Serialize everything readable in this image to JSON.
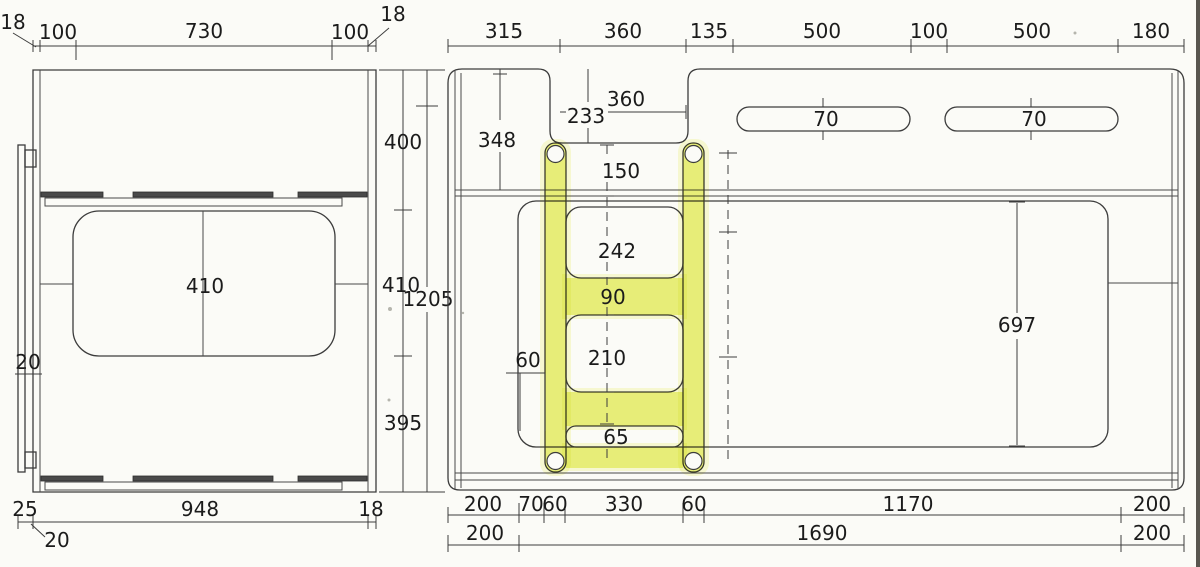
{
  "drawing": {
    "title": "bunk-bed-panel-technical-drawing",
    "background": "#fbfbf7",
    "line_color": "#3c3c3c",
    "text_color": "#1b1b1b",
    "highlight_color": "#f0f593",
    "side_view": {
      "thickness_top_left": "18",
      "top_dims": [
        "100",
        "730",
        "100"
      ],
      "thickness_top_right": "18",
      "height_dims": [
        "400",
        "410",
        "395"
      ],
      "cutout_height": "410",
      "ladder_bar_thickness": "20",
      "bottom_dims": [
        "25",
        "948",
        "18"
      ],
      "bottom_offset_leader": "20"
    },
    "front_view": {
      "overall_height": "1205",
      "top_dims": [
        "315",
        "360",
        "135",
        "500",
        "100",
        "500",
        "180"
      ],
      "left_height_to_rail": "348",
      "notch_depth": "233",
      "notch_width": "360",
      "notch_to_rail": "150",
      "slot_widths": [
        "70",
        "70"
      ],
      "ladder": {
        "opening_top": "242",
        "rung_height": "90",
        "opening_mid": "210",
        "opening_bottom": "65",
        "rail_offset": "60"
      },
      "bed_panel_height": "697",
      "bottom_row1": [
        "200",
        "70",
        "60",
        "330",
        "60",
        "1170",
        "200"
      ],
      "bottom_row2": [
        "200",
        "1690",
        "200"
      ]
    }
  }
}
